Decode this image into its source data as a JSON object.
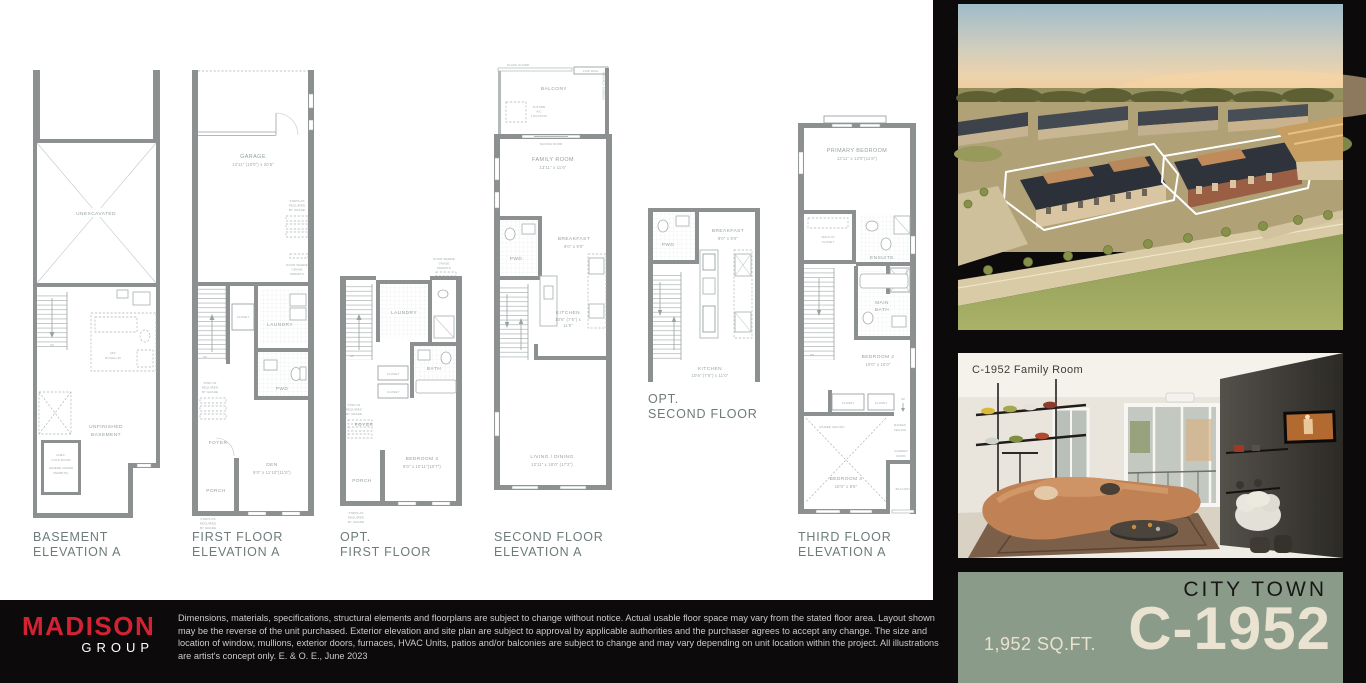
{
  "sheet": {
    "bg": "#ffffff",
    "panel_bg": "#0d0a0b"
  },
  "plan_basement": {
    "caption_line1": "BASEMENT",
    "caption_line2": "ELEVATION A",
    "unexcavated": "UNEXCAVATED",
    "unfinished_line1": "UNFINISHED",
    "unfinished_line2": "BASEMENT",
    "up": "UP",
    "rough_in_line1": "3PC",
    "rough_in_line2": "ROUGH-IN",
    "cold_room_line1": "UNEX.",
    "cold_room_line2": "COLD ROOM",
    "cold_room_line3": "(WHERE GRADE",
    "cold_room_line4": "PERMITS)"
  },
  "plan_first": {
    "caption_line1": "FIRST FLOOR",
    "caption_line2": "ELEVATION A",
    "garage": "GARAGE",
    "garage_dims": "13'11\" (10'0\") x 20'5\"",
    "steps_note_line1": "STEPS AS",
    "steps_note_line2": "REQUIRED",
    "steps_note_line3": "BY GRADE",
    "door_note_line1": "DOOR WHERE",
    "door_note_line2": "GRADE",
    "door_note_line3": "PERMITS",
    "up": "UP",
    "closet": "CLOSET",
    "laundry": "LAUNDRY",
    "pwd": "PWD",
    "foyer": "FOYER",
    "porch": "PORCH",
    "den": "DEN",
    "den_dims": "9'0\" x 11'10\"(11'0\")",
    "step_note_line1": "STEP AS",
    "step_note_line2": "REQUIRED",
    "step_note_line3": "BY GRADE",
    "steps_note2_line1": "STEPS AS",
    "steps_note2_line2": "REQUIRED",
    "steps_note2_line3": "BY GRADE"
  },
  "plan_opt_first": {
    "caption_line1": "OPT.",
    "caption_line2": "FIRST FLOOR",
    "door_note_line1": "DOOR WHERE",
    "door_note_line2": "GRADE",
    "door_note_line3": "PERMITS",
    "up": "UP",
    "laundry": "LAUNDRY",
    "bath": "BATH",
    "closet1": "CLOSET",
    "closet2": "CLOSET",
    "foyer": "FOYER",
    "porch": "PORCH",
    "bedroom4": "BEDROOM 4",
    "bedroom4_dims": "9'0\" x 10'11\"(10'7\")",
    "step_note_line1": "STEP AS",
    "step_note_line2": "REQUIRED",
    "step_note_line3": "BY GRADE",
    "steps_note_line1": "STEPS AS",
    "steps_note_line2": "REQUIRED",
    "steps_note_line3": "BY GRADE"
  },
  "plan_second": {
    "caption_line1": "SECOND FLOOR",
    "caption_line2": "ELEVATION A",
    "glass_guard": "GLASS GUARD",
    "low_wall": "LOW WALL",
    "balcony": "BALCONY",
    "future_ac_line1": "FUTURE",
    "future_ac_line2": "A/C",
    "future_ac_line3": "LOCATION",
    "privacy_screen": "PRIVACY SCREEN",
    "sliding_door": "SLIDING DOOR",
    "family_room": "FAMILY ROOM",
    "family_room_dims": "13'11\" x 11'6\"",
    "pwd": "PWD",
    "breakfast": "BREAKFAST",
    "breakfast_dims": "9'0\" x 9'0\"",
    "kitchen": "KITCHEN",
    "kitchen_dims_line1": "10'6\" (7'6\") x",
    "kitchen_dims_line2": "11'0\"",
    "living": "LIVING / DINING",
    "living_dims": "13'11\" x 18'0\" (17'2\")"
  },
  "plan_opt_second": {
    "caption_line1": "OPT.",
    "caption_line2": "SECOND FLOOR",
    "pwd": "PWD",
    "breakfast": "BREAKFAST",
    "breakfast_dims": "9'0\" x 9'0\"",
    "kitchen": "KITCHEN",
    "kitchen_dims": "10'6\" (7'6\") x 11'0\""
  },
  "plan_third": {
    "caption_line1": "THIRD FLOOR",
    "caption_line2": "ELEVATION A",
    "primary_bedroom": "PRIMARY BEDROOM",
    "primary_dims": "13'11\" x 13'0\"(11'8\")",
    "wic_line1": "WALK-IN",
    "wic_line2": "CLOSET",
    "ensuite": "ENSUITE",
    "linen": "LINEN",
    "dn": "DN",
    "main_bath_line1": "MAIN",
    "main_bath_line2": "BATH",
    "bedroom2": "BEDROOM 2",
    "bedroom2_dims": "10'0\" x 10'0\"",
    "closet1": "CLOSET",
    "closet2": "CLOSET",
    "up": "UP",
    "raised_ceiling_left": "RAISED CEILING",
    "raised_ceiling_right_line1": "RAISED",
    "raised_ceiling_right_line2": "CEILING",
    "garden_door_line1": "GARDEN",
    "garden_door_line2": "DOOR",
    "balcony": "BALCONY",
    "bedroom3": "BEDROOM 3",
    "bedroom3_dims": "10'0\" x 8'6\""
  },
  "photos": {
    "family_room_label": "C-1952 Family Room"
  },
  "badge": {
    "collection": "CITY TOWN",
    "model": "C-1952",
    "area": "1,952 SQ.FT.",
    "bg": "#8b9b89",
    "cream": "#ebe3d1"
  },
  "footer": {
    "brand": "MADISON",
    "brand_sub": "GROUP",
    "brand_color": "#d22233",
    "disclaimer": "Dimensions, materials, specifications, structural elements and floorplans are subject to change without notice. Actual usable floor space may vary from the stated floor area. Layout shown may be the reverse of the unit purchased. Exterior elevation and site plan are subject to approval by applicable authorities and the purchaser agrees to accept any change. The size and location of window, mullions, exterior doors, furnaces, HVAC Units, patios and/or balconies are subject to change and may vary depending on unit location within the project. All illustrations are artist's concept only. E. & O. E., June 2023"
  }
}
